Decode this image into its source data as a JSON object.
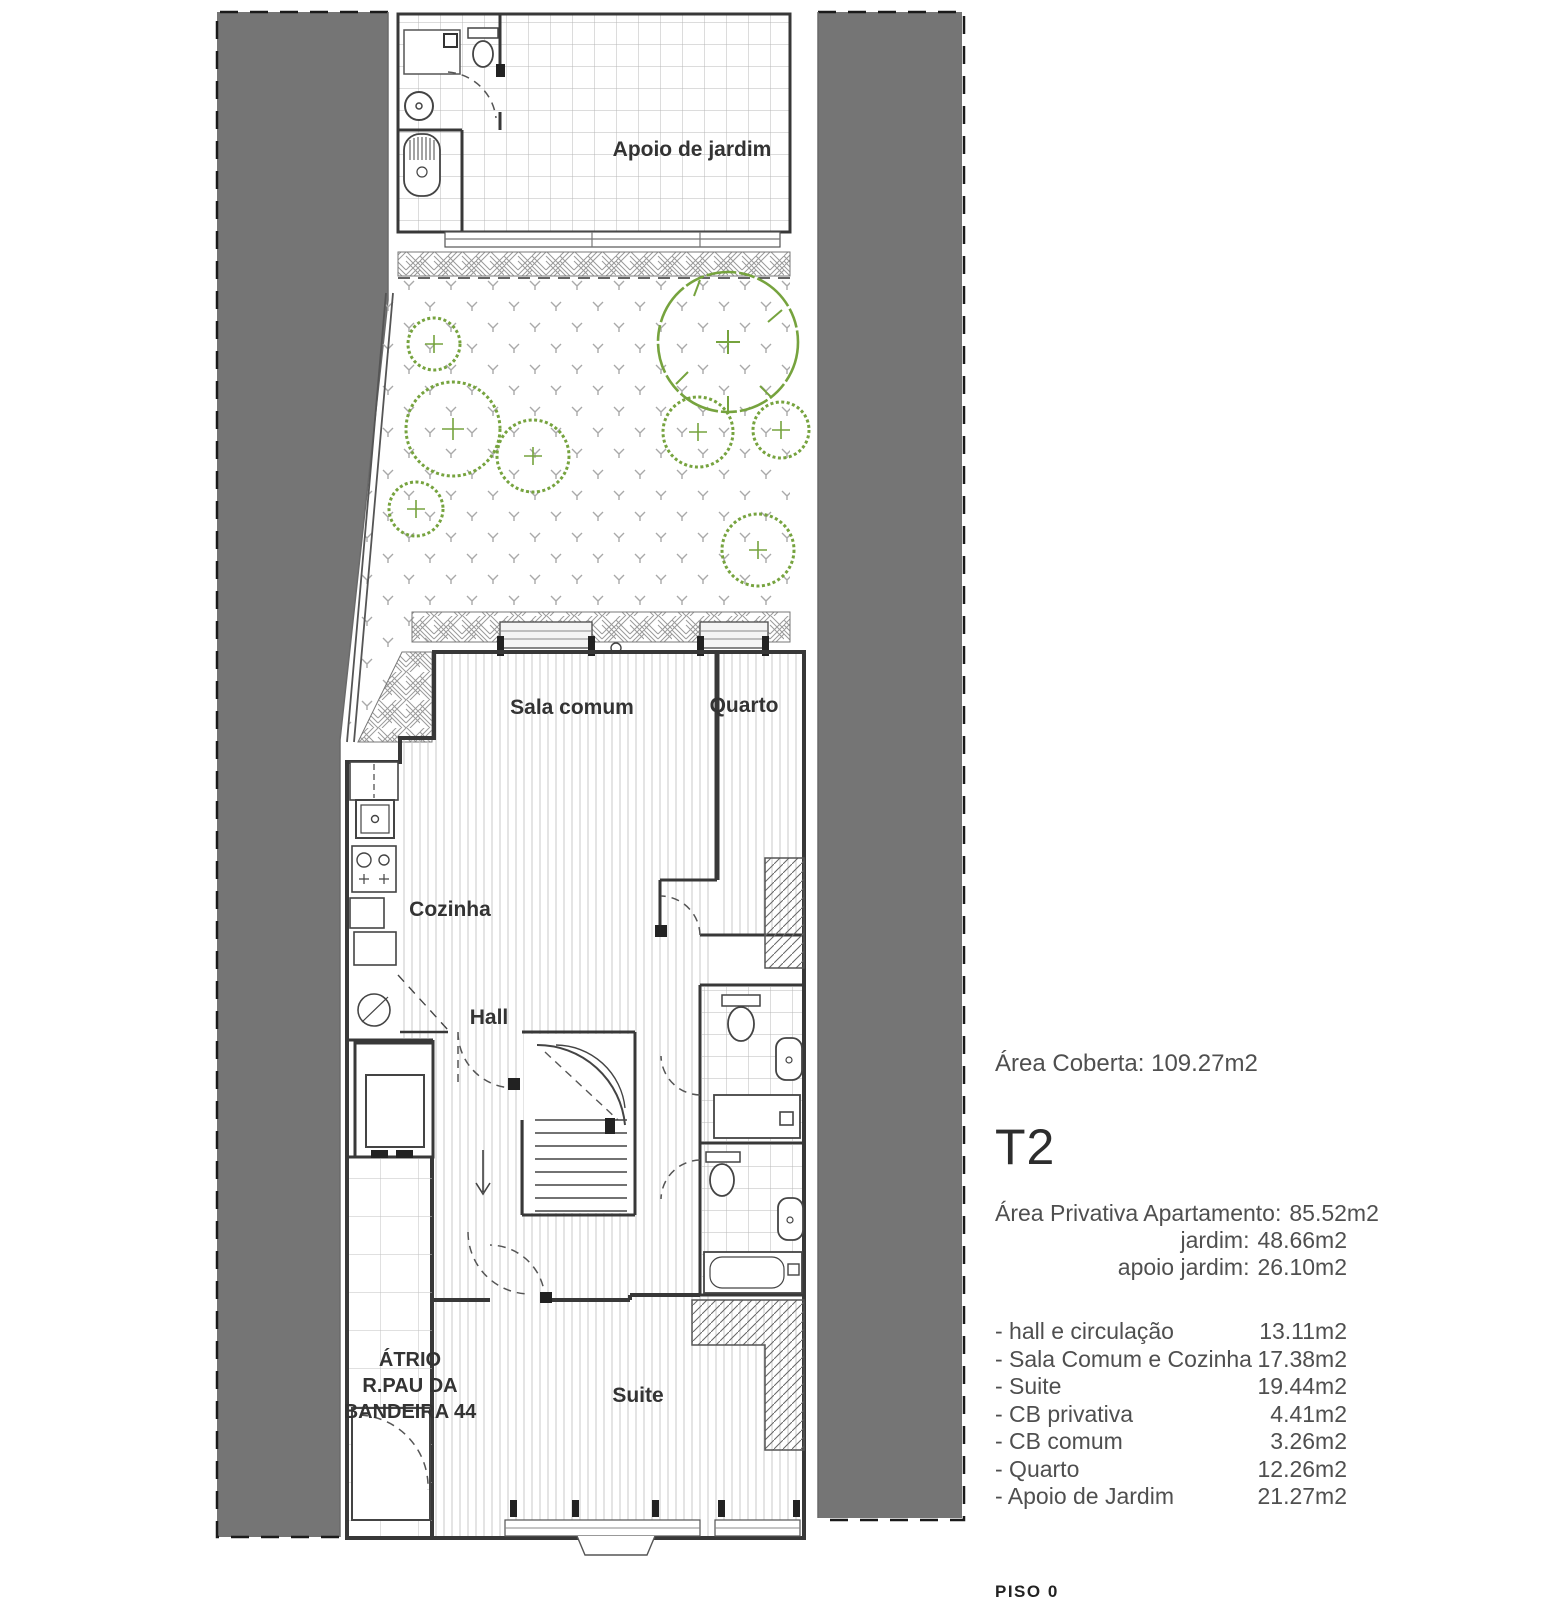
{
  "colors": {
    "neighbor_band": "#757575",
    "wall": "#383838",
    "vegetation_green": "#76a33e",
    "floor_line": "#c9c9c9",
    "panel_text": "#4f4f4f"
  },
  "plan": {
    "labels": {
      "apoio": "Apoio de jardim",
      "sala": "Sala comum",
      "quarto": "Quarto",
      "cozinha": "Cozinha",
      "hall": "Hall",
      "suite": "Suite",
      "atrio": [
        "ÁTRIO",
        "R.PAU DA",
        "BANDEIRA 44"
      ]
    }
  },
  "panel": {
    "area_coberta_label": "Área Coberta:",
    "area_coberta_value": "109.27m2",
    "unit": "T2",
    "private_areas": [
      {
        "label": "Área Privativa Apartamento:",
        "value": "85.52m2"
      },
      {
        "label": "jardim:",
        "value": "48.66m2"
      },
      {
        "label": "apoio jardim:",
        "value": "26.10m2"
      }
    ],
    "rooms": [
      {
        "label": "- hall e circulação",
        "value": "13.11m2"
      },
      {
        "label": "- Sala Comum e Cozinha",
        "value": "17.38m2"
      },
      {
        "label": "- Suite",
        "value": "19.44m2"
      },
      {
        "label": "- CB privativa",
        "value": "4.41m2"
      },
      {
        "label": "- CB comum",
        "value": "3.26m2"
      },
      {
        "label": "- Quarto",
        "value": "12.26m2"
      },
      {
        "label": "- Apoio de Jardim",
        "value": "21.27m2"
      }
    ],
    "floor": "PISO 0"
  }
}
